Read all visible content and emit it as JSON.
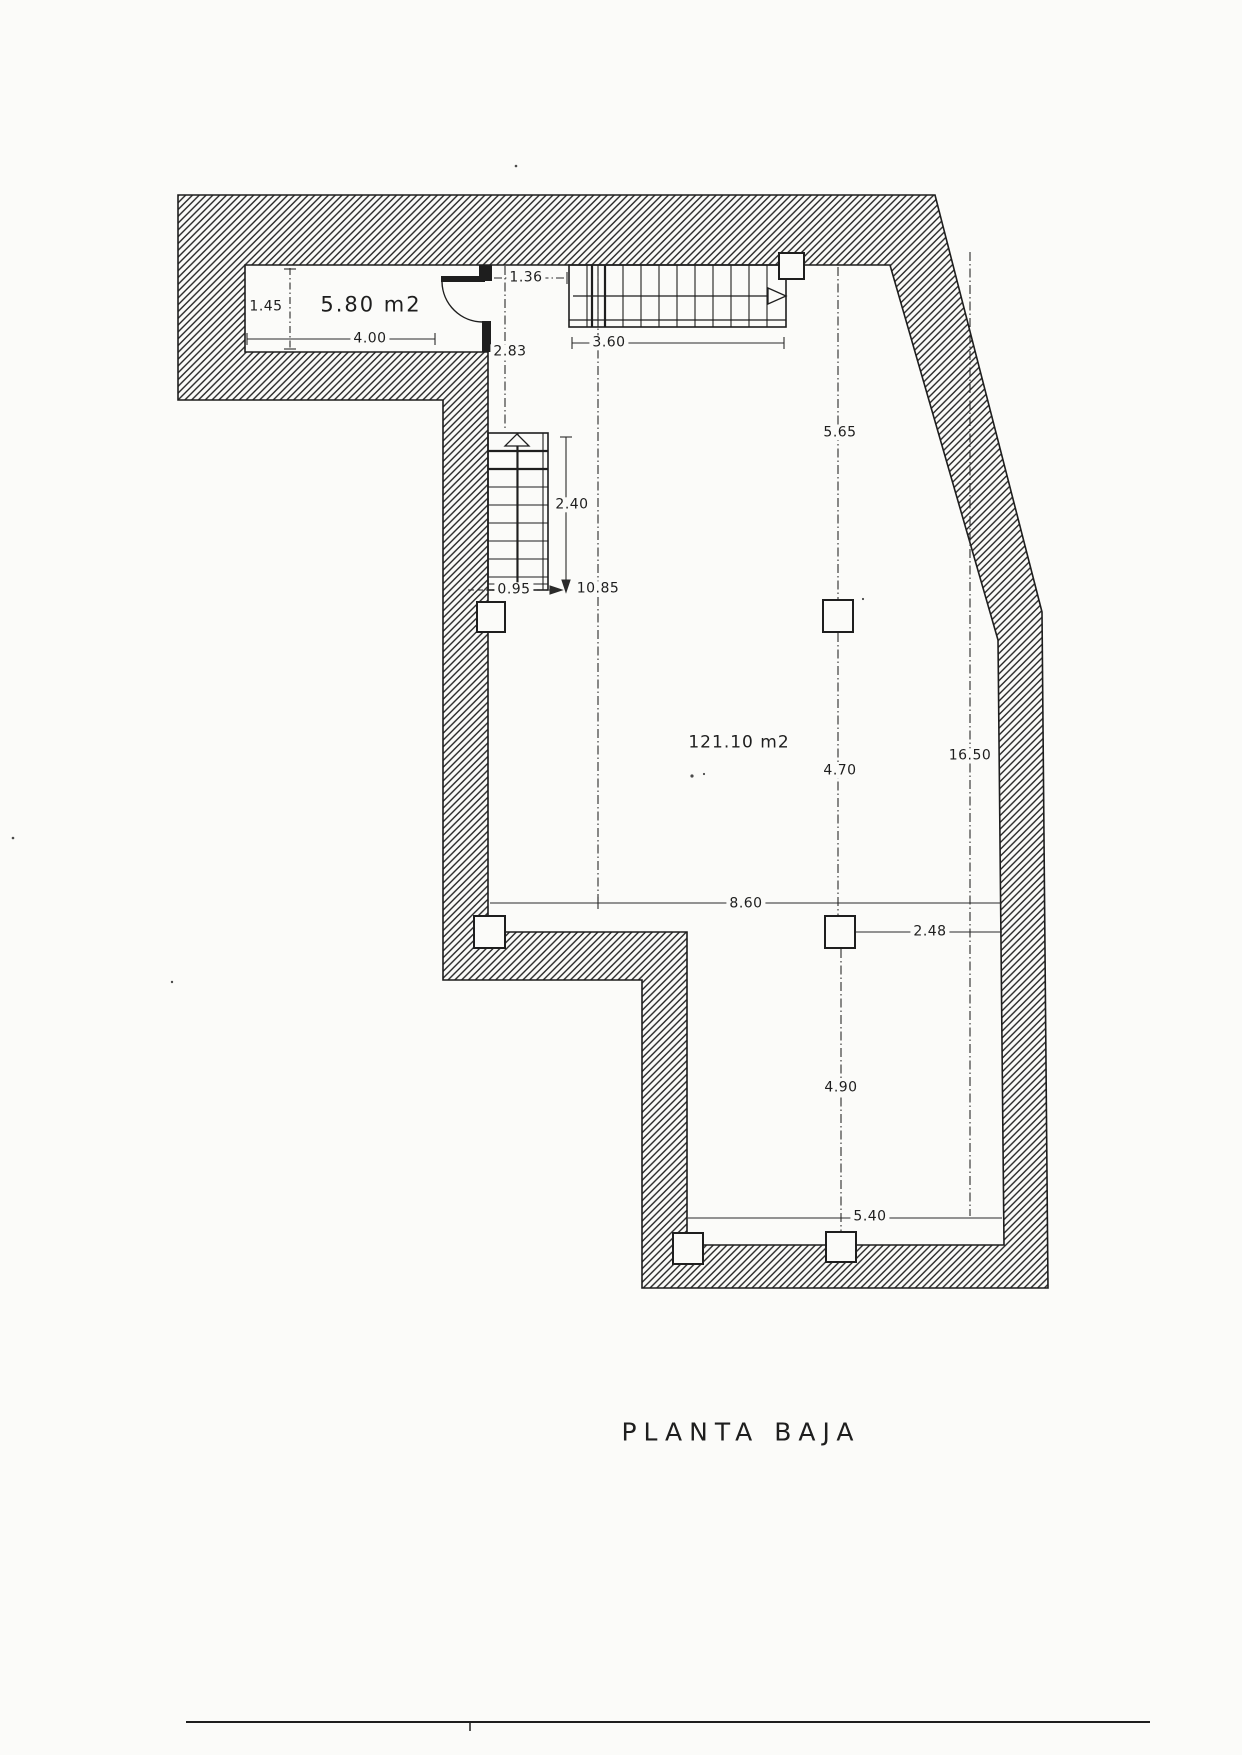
{
  "title": "PLANTA BAJA",
  "rooms": {
    "small_room_area": "5.80 m2",
    "main_room_area": "121.10 m2"
  },
  "dimensions": {
    "room_height": "1.45",
    "room_width": "4.00",
    "door_opening": "1.36",
    "entry_depth": "2.83",
    "top_stair_length": "3.60",
    "mid_stair_length": "2.40",
    "stair_width": "0.95",
    "hall_depth": "10.85",
    "col_span_top": "5.65",
    "col_span_mid": "4.70",
    "total_depth": "16.50",
    "main_width": "8.60",
    "col_to_wall": "2.48",
    "col_span_bottom": "4.90",
    "bottom_width": "5.40"
  },
  "colors": {
    "paper": "#fbfbf9",
    "ink": "#1e1e1e"
  }
}
